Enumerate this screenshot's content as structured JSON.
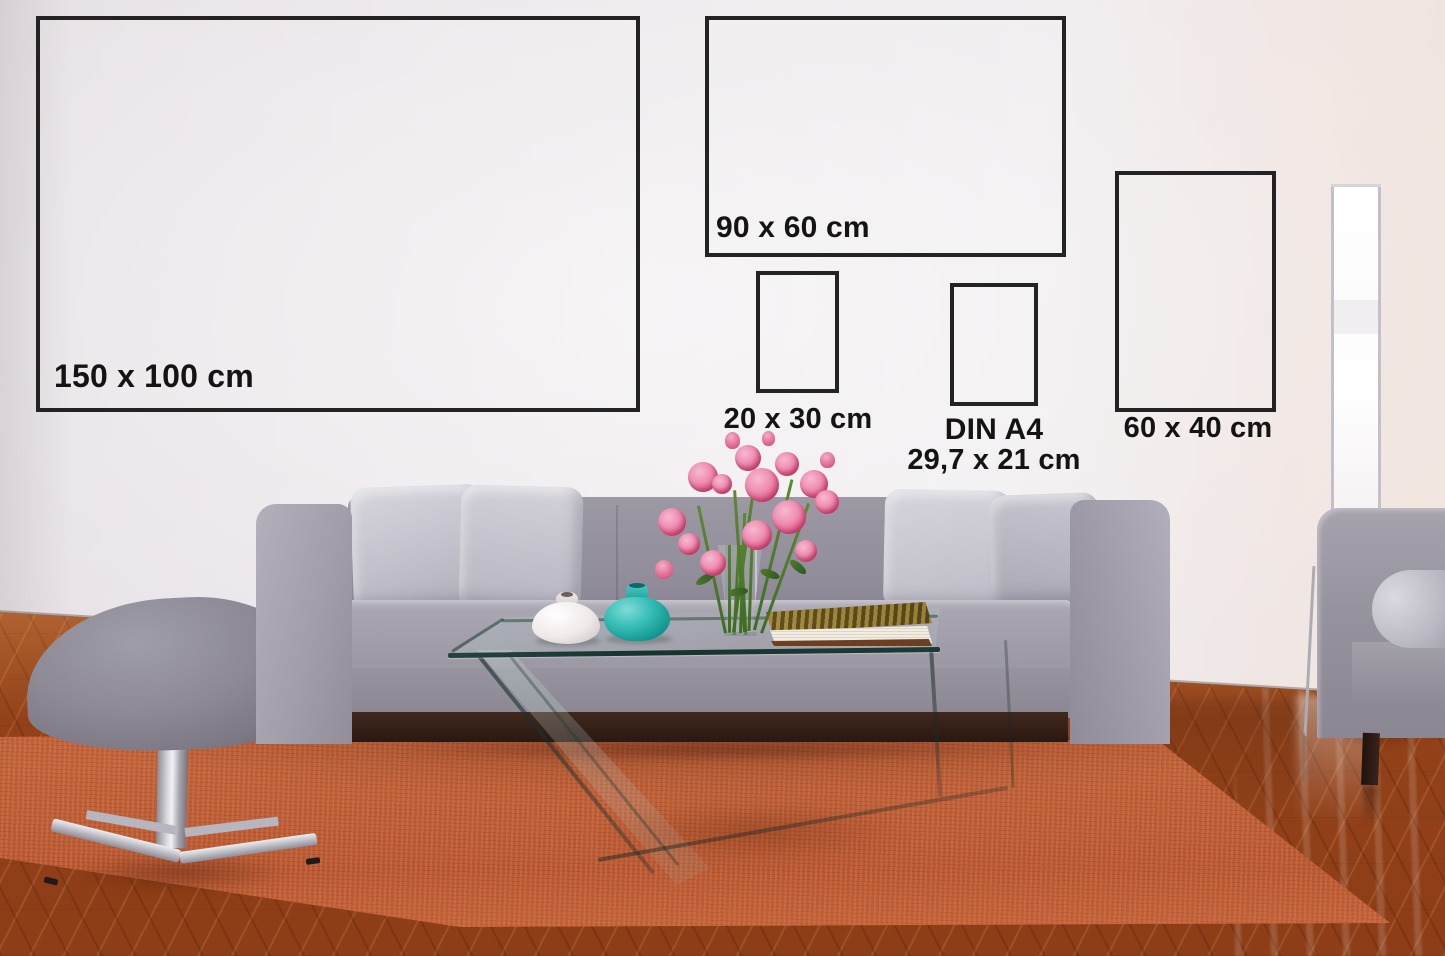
{
  "frames": [
    {
      "id": "150x100",
      "label": "150 x 100 cm"
    },
    {
      "id": "90x60",
      "label": "90 x 60 cm"
    },
    {
      "id": "20x30",
      "label": "20 x 30 cm"
    },
    {
      "id": "din-a4",
      "label": "DIN A4",
      "sublabel": "29,7 x 21 cm"
    },
    {
      "id": "60x40",
      "label": "60 x 40 cm"
    }
  ],
  "colors": {
    "wall": "#ebe5e9",
    "frame_border": "#232323",
    "label_text": "#141414",
    "rug": "#b5502a",
    "wood_floor": "#a4511b",
    "sofa_fabric": "#9b97a3",
    "pillow": "#cfced7",
    "stool": "#8d8a96",
    "teal_vase": "#1fa8a1",
    "white_vase": "#f0e9e9",
    "flower_pink": "#e56f9e",
    "lamp_white": "#ffffff",
    "book_cover": "#8a6c2c",
    "glass_edge": "#1d3a36"
  }
}
